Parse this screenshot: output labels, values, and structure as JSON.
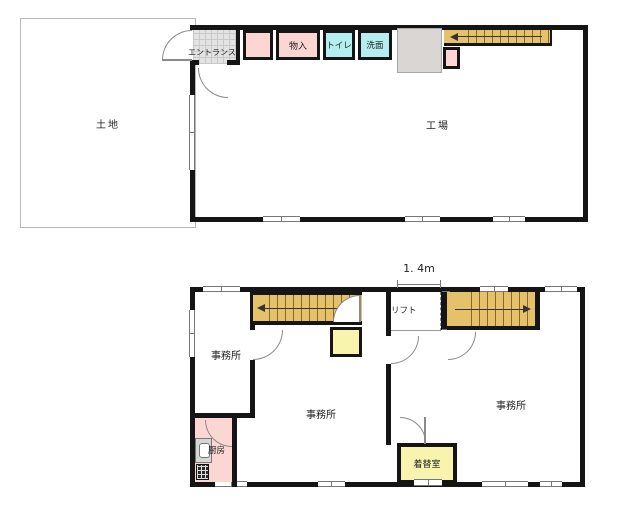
{
  "floor1": {
    "land_label": "土地",
    "factory_label": "工場",
    "entrance_label": "エントランス",
    "storage_label": "物入",
    "toilet_label": "トイレ",
    "washroom_label": "洗面"
  },
  "floor2": {
    "office_small_label": "事務所",
    "office_center_label": "事務所",
    "office_right_label": "事務所",
    "lift_label": "リフト",
    "kitchen_label": "厨房",
    "changing_room_label": "着替室",
    "dim_width": "1. 4m",
    "dim_height": "1.6m"
  },
  "colors": {
    "wall": "#151515",
    "room_pink": "#fbd6d2",
    "room_cyan": "#b5eef1",
    "stairs_yellow": "#e5c269",
    "room_pale_yellow": "#f8f4ae",
    "entrance_gray": "#e3e3e3"
  }
}
